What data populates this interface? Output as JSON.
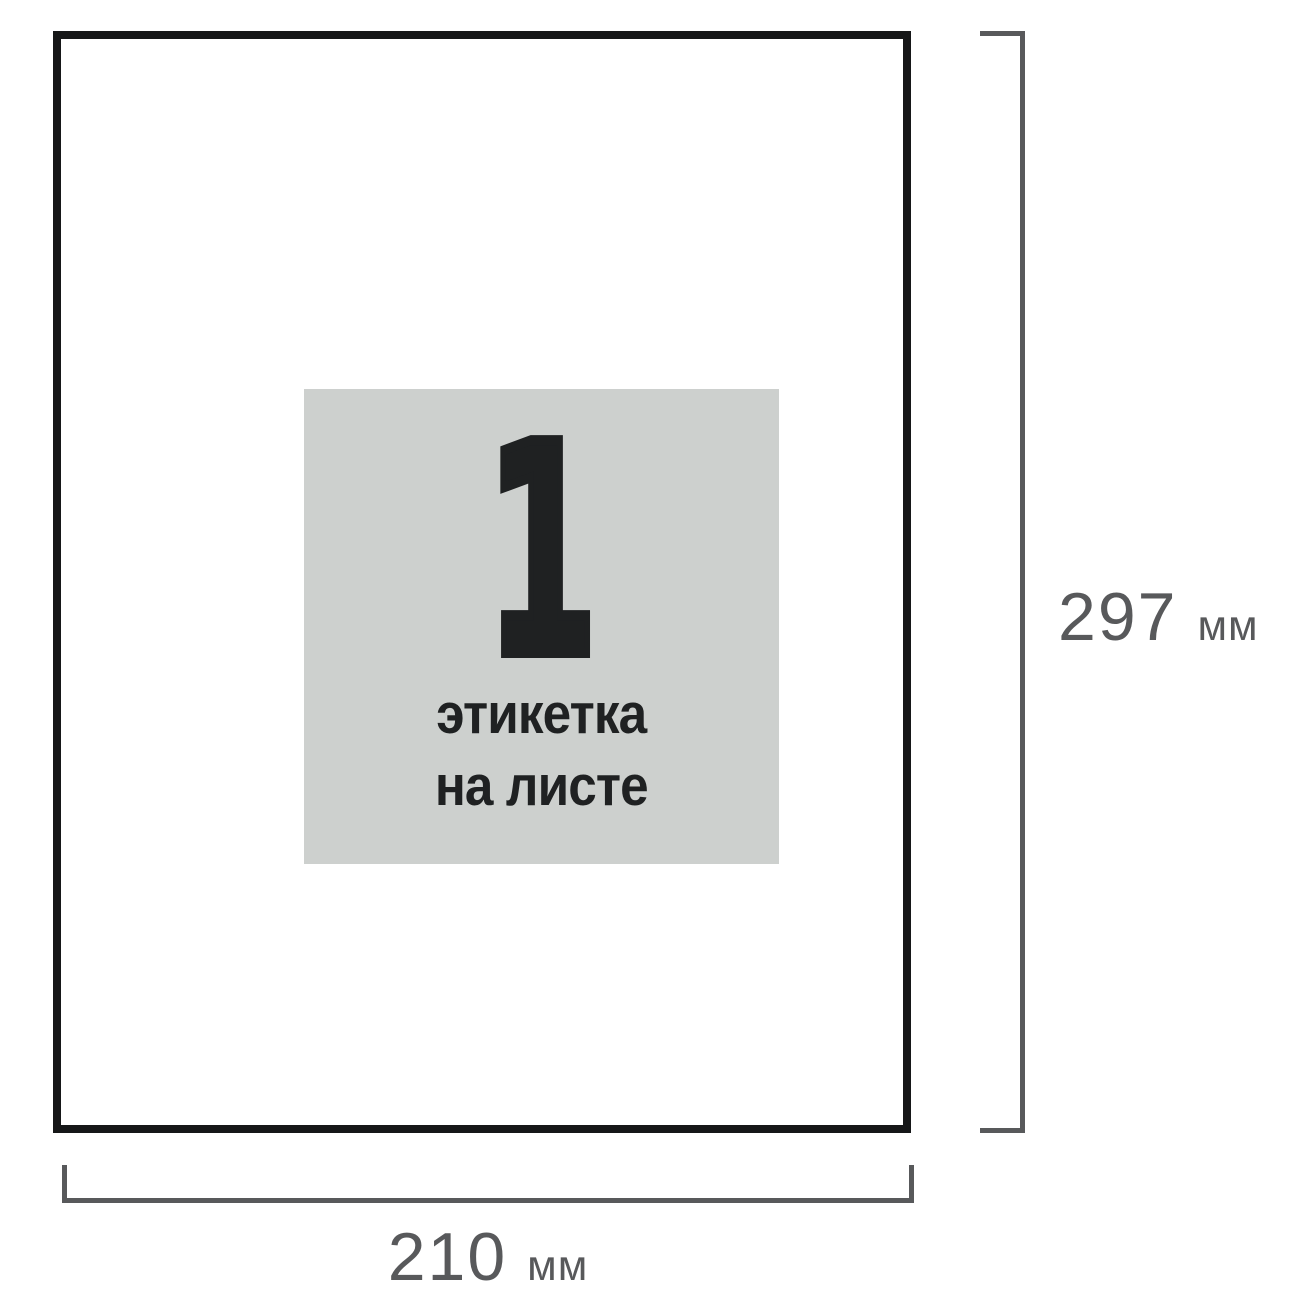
{
  "figure": {
    "sheet": {
      "label_block": {
        "count": "1",
        "caption_line1": "этикетка",
        "caption_line2": "на листе"
      },
      "dimensions": {
        "height": {
          "value": "297",
          "unit": "мм"
        },
        "width": {
          "value": "210",
          "unit": "мм"
        }
      }
    },
    "colors": {
      "background": "#ffffff",
      "sheet_border": "#161718",
      "label_background": "#cdd0ce",
      "label_text": "#1f2122",
      "dimension": "#58595b"
    }
  }
}
